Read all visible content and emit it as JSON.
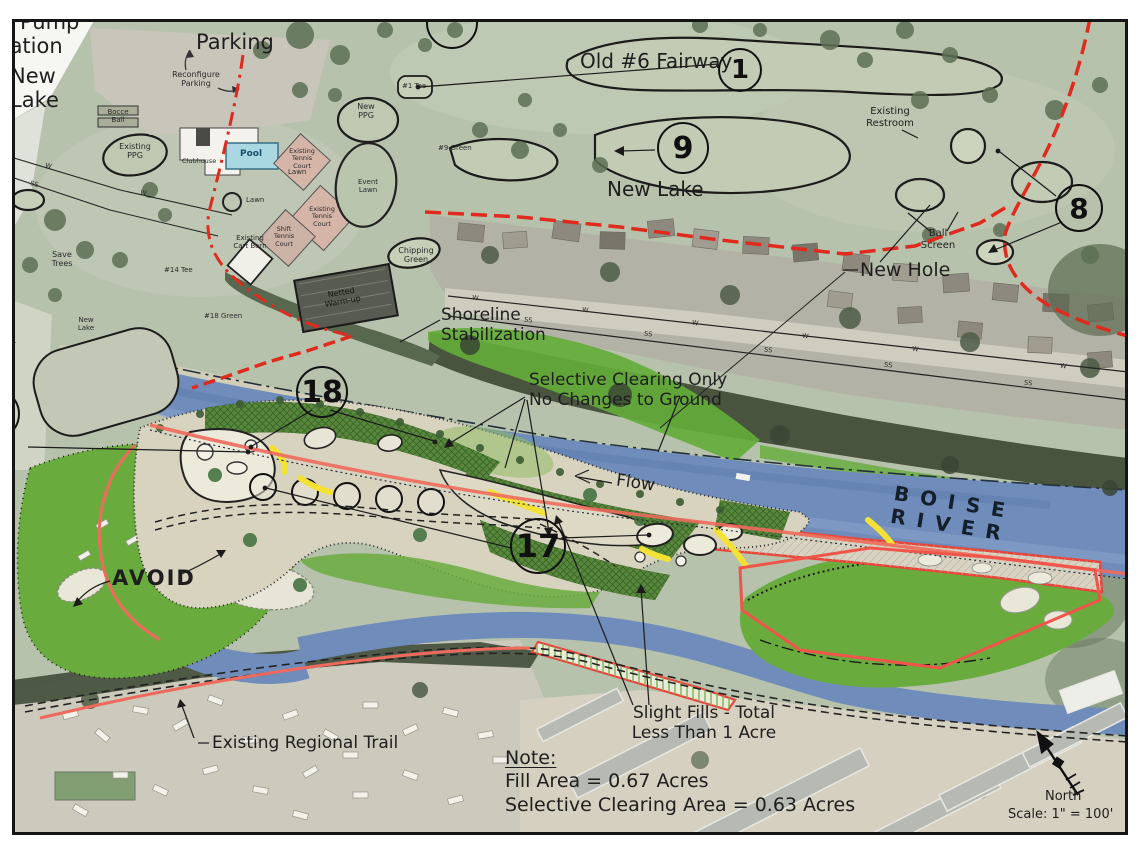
{
  "labels": {
    "pump_station": "Pump\nStation",
    "new_lake_nw": "New\nLake",
    "parking": "Parking",
    "reconfigure_parking": "Reconfigure\nParking",
    "old_6_fairway": "Old #6 Fairway",
    "tee_1": "#1 Tee",
    "green_9": "#9 Green",
    "new_lake_mid": "New Lake",
    "existing_restroom": "Existing\nRestroom",
    "ball_screen": "Ball\nScreen",
    "new_hole": "New Hole",
    "shoreline_stabilization": "Shoreline\nStabilization",
    "selective_clearing_note": "Selective Clearing Only\nNo Changes to Ground",
    "flow": "Flow",
    "boise_river": "BOISE RIVER",
    "avoid": "AVOID",
    "existing_regional_trail": "Existing Regional Trail",
    "slight_fills": "Slight Fills - Total\nLess Than 1 Acre",
    "note_heading": "Note:",
    "fill_area": "Fill Area = 0.67 Acres",
    "selective_clearing_area": "Selective Clearing Area = 0.63 Acres",
    "north": "North",
    "scale": "Scale: 1\" = 100'",
    "sewer_line": "Sewer\nLine",
    "new_lake_small": "New\nLake",
    "green_18": "#18 Green",
    "tee_14": "#14 Tee",
    "save_trees": "Save\nTrees",
    "bocce_ball": "Bocce\nBall",
    "existing_ppg": "Existing\nPPG",
    "new_ppg": "New\nPPG",
    "clubhouse": "Clubhouse",
    "pool": "Pool",
    "lawn_a": "Lawn",
    "lawn_b": "Lawn",
    "event_lawn": "Event\nLawn",
    "existing_tennis_a": "Existing\nTennis\nCourt",
    "existing_tennis_b": "Existing\nTennis\nCourt",
    "shift_tennis": "Shift\nTennis\nCourt",
    "existing_cart_barn": "Existing\nCart Barn",
    "chipping_green": "Chipping\nGreen",
    "netted_warmup": "Netted\nWarm-up"
  },
  "holes": {
    "h1": "1",
    "h9": "9",
    "h8": "8",
    "h18": "18",
    "h17": "17",
    "h17_top": "17",
    "h5_left": "5"
  },
  "utility": {
    "w": "W",
    "ss": "SS"
  },
  "colors": {
    "boundary_red": "#e02a1e",
    "shoreline_pink": "#ee6a5c",
    "river_blue": "#6f8cba",
    "clearing_green": "#67aa3c",
    "turf_sage": "#b7c2ad",
    "fairway_tan": "#d9d4c0",
    "path_yellow": "#f3e135",
    "pool_blue": "#a9d7e2"
  }
}
